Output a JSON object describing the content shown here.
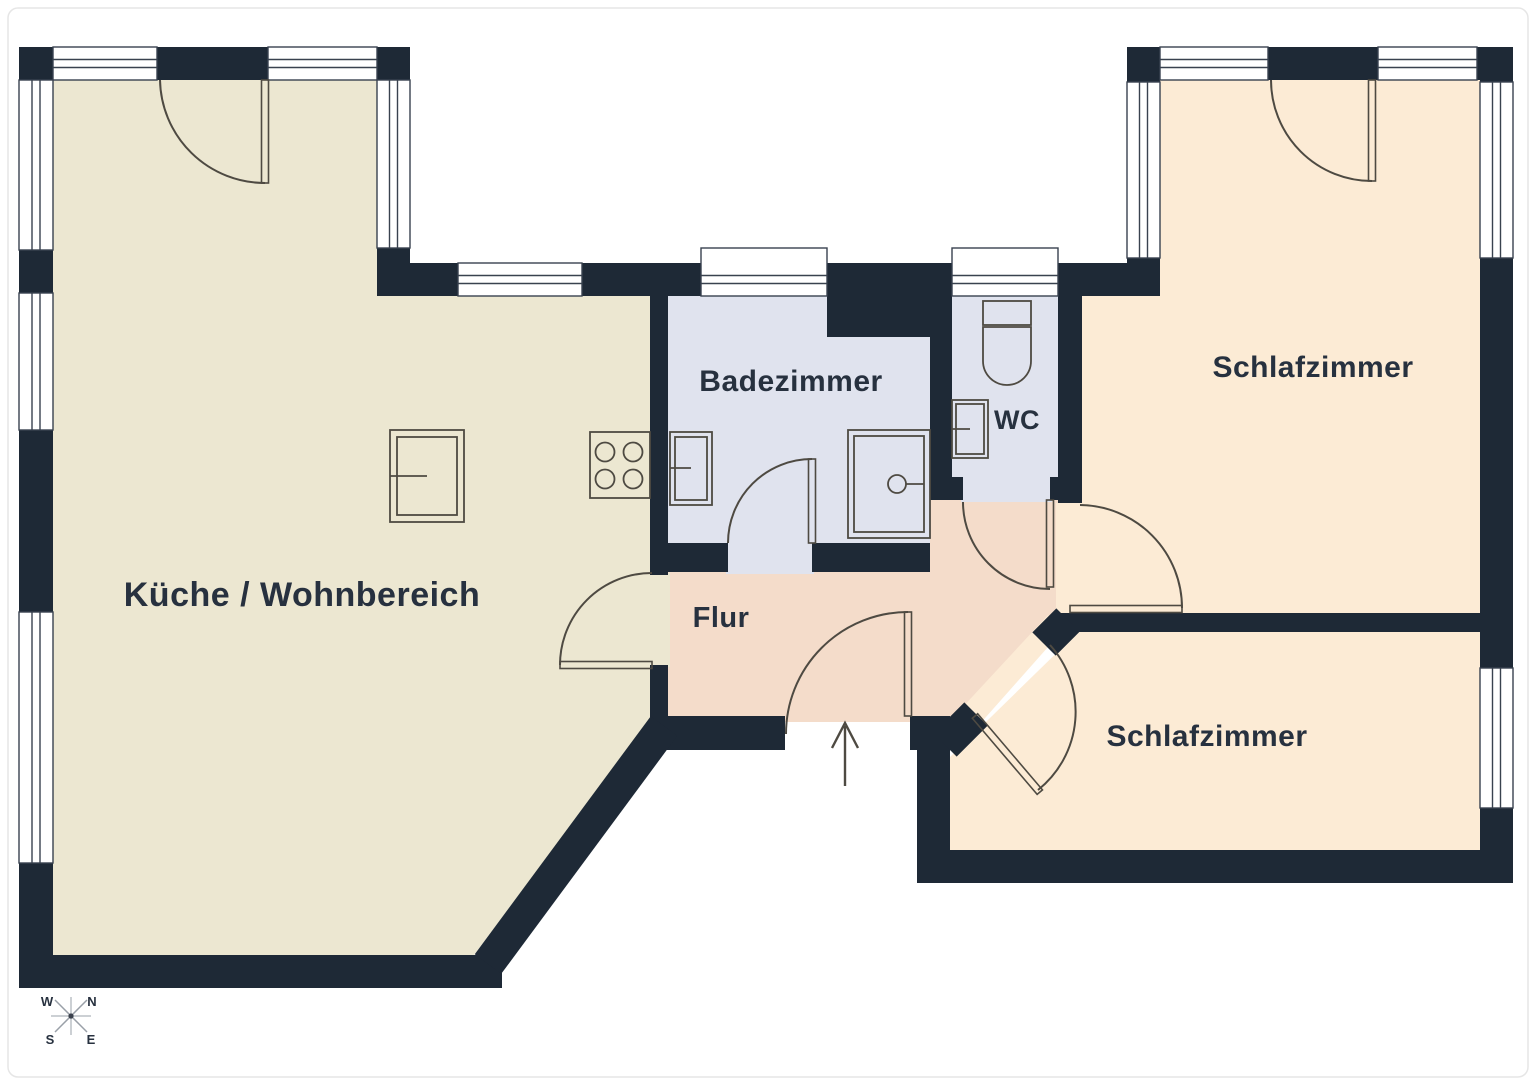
{
  "plan": {
    "type": "apartment-floor-plan",
    "rooms": {
      "kitchen": {
        "label": "Küche / Wohnbereich"
      },
      "bathroom": {
        "label": "Badezimmer"
      },
      "wc": {
        "label": "WC"
      },
      "hall": {
        "label": "Flur"
      },
      "bedroom_top": {
        "label": "Schlafzimmer"
      },
      "bedroom_bottom": {
        "label": "Schlafzimmer"
      }
    },
    "compass": {
      "w": "W",
      "n": "N",
      "s": "S",
      "e": "E"
    },
    "colors": {
      "wall": "#1e2936",
      "kitchen_floor": "#ece7d1",
      "bathroom_floor": "#e0e3ee",
      "hall_floor": "#f4dcca",
      "bedroom_floor": "#fcebd5",
      "line": "#4e4a42",
      "frame": "#39424f",
      "label": "#27313f",
      "compass_ray": "#9aa0a8",
      "page_border": "#e6e6e6"
    }
  }
}
